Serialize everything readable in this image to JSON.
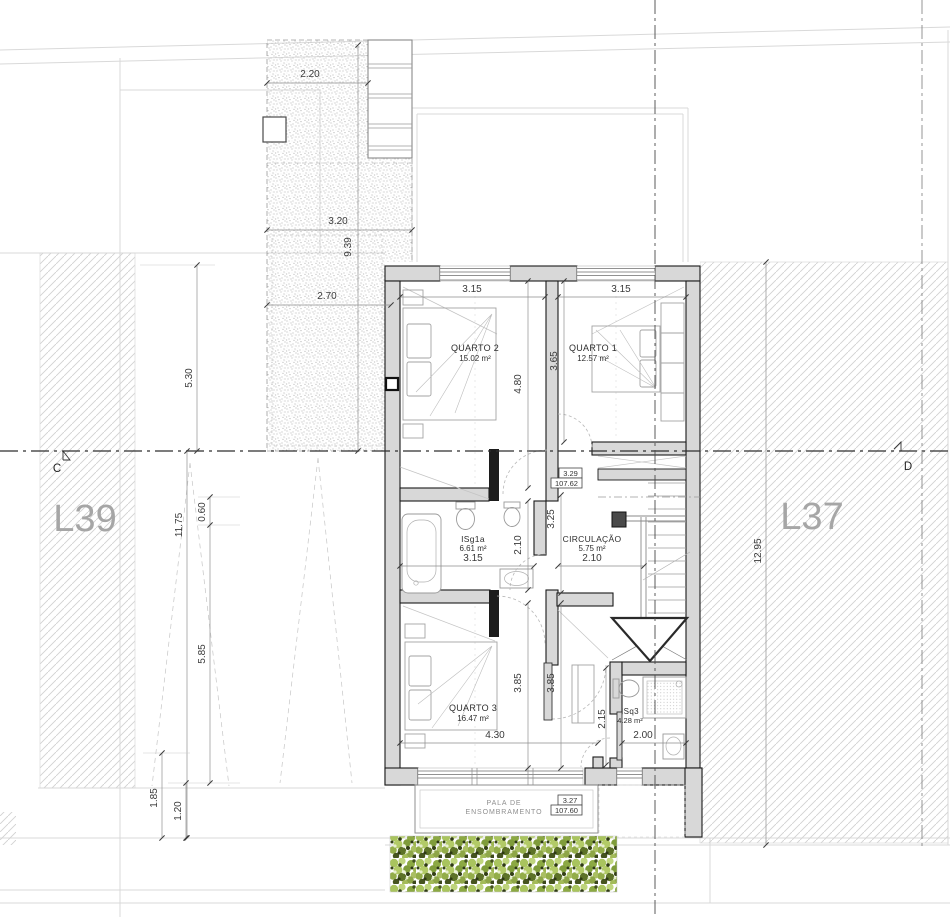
{
  "drawing": {
    "type": "architectural floor plan, first floor"
  },
  "lots": {
    "left": "L39",
    "right": "L37"
  },
  "section": {
    "left": "C",
    "right": "D"
  },
  "rooms": [
    {
      "name": "QUARTO 2",
      "area": "15.02 m²"
    },
    {
      "name": "QUARTO 1",
      "area": "12.57 m²"
    },
    {
      "name": "ISg1a",
      "area": "6.61 m²"
    },
    {
      "name": "CIRCULAÇÃO",
      "area": "5.75 m²"
    },
    {
      "name": "QUARTO 3",
      "area": "16.47 m²"
    },
    {
      "name": "ISq3",
      "area": "4.28 m²"
    }
  ],
  "levels": [
    {
      "value": "3.29",
      "elevation": "107.62"
    },
    {
      "value": "3.27",
      "elevation": "107.60"
    }
  ],
  "shading_canopy": {
    "line1": "PALA DE",
    "line2": "ENSOMBRAMENTO"
  },
  "dims": {
    "terrace_top_width": "2.20",
    "terrace_mid_width": "3.20",
    "terrace_length": "9.39",
    "terrace_lower_width": "2.70",
    "left_upper": "5.30",
    "left_total": "11.75",
    "left_offset": "0.60",
    "left_lower": "5.85",
    "left_bottom_a": "1.85",
    "left_bottom_b": "1.20",
    "right_total": "12.95",
    "quarto2_width": "3.15",
    "quarto2_depth": "4.80",
    "quarto1_width": "3.15",
    "quarto1_depth": "3.65",
    "bath1_width": "3.15",
    "bath1_depth": "2.10",
    "circ_depth": "3.25",
    "circ_width": "2.10",
    "quarto3_depth_a": "3.85",
    "quarto3_depth_b": "3.85",
    "quarto3_width": "4.30",
    "bath3_depth": "2.15",
    "bath3_width": "2.00"
  }
}
